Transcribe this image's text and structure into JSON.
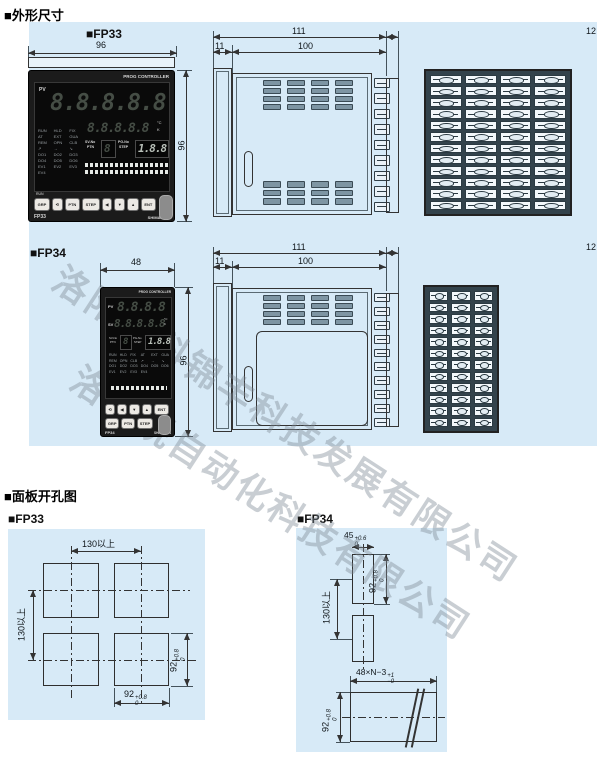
{
  "titles": {
    "outline": "■外形尺寸",
    "cutout": "■面板开孔图"
  },
  "labels": {
    "fp33": "■FP33",
    "fp34": "■FP34",
    "fp33_cut": "■FP33",
    "fp34_cut": "■FP34"
  },
  "watermark": {
    "line1": "洛阳瑞科锦丰科技发展有限公司",
    "line2": "洛阳锐自动化科技有限公司"
  },
  "colors": {
    "panel_bg": "#d7eaf7",
    "line": "#333333",
    "device": "#1b1b1b"
  },
  "fp33": {
    "front": {
      "brand": "PROG CONTROLLER",
      "pv": "PV",
      "pv_digits": "8.8.8.8.8",
      "sv_digits": "8.8.8.8.8",
      "unit_top": "°C",
      "unit_bottom": "K",
      "ptn_label_top": "SV-No",
      "ptn_label_bottom": "PTN",
      "step_label_top": "PG-No",
      "step_label_bottom": "STEP",
      "ptn_value": "8",
      "step_value": "1.8.8",
      "run": "RUN",
      "status": [
        "RUN",
        "HLD",
        "FIX",
        "AT",
        "EXT",
        "GUA",
        "REM",
        "OPN",
        "CLB",
        "↗",
        "→",
        "↘",
        "DO1",
        "DO2",
        "DO3",
        "DO4",
        "DO5",
        "DO6",
        "EV1",
        "EV2",
        "EV3",
        "EV4"
      ],
      "buttons": [
        "GRP",
        "⟲",
        "PTN",
        "STEP",
        "◀",
        "▼",
        "▲",
        "ENT"
      ],
      "model": "FP33",
      "maker": "SHIMADEN"
    },
    "dims": {
      "front_width": "96",
      "front_height": "96",
      "depth_total": "111",
      "depth_body": "100",
      "bezel": "11",
      "terminal": "12"
    }
  },
  "fp34": {
    "front": {
      "brand": "PROG CONTROLLER",
      "pv": "PV",
      "sv": "SV",
      "pv_digits": "8.8.8.8",
      "sv_digits": "8.8.8.8.8",
      "unit_top": "°C",
      "unit_bottom": "K",
      "ptn_label_top": "SV-No",
      "ptn_label_bottom": "PTN",
      "step_label_top": "PG-No",
      "step_label_bottom": "STEP",
      "ptn_value": "8",
      "step_value": "1.8.8",
      "status": [
        "RUN",
        "HLD",
        "FIX",
        "AT",
        "EXT",
        "GUA",
        "REM",
        "OPN",
        "CLB",
        "↗",
        "→",
        "↘",
        "DO1",
        "DO2",
        "DO3",
        "DO4",
        "DO5",
        "DO6",
        "EV1",
        "EV2",
        "EV3",
        "EV4"
      ],
      "buttons_row1": [
        "⟲",
        "◀",
        "▼",
        "▲",
        "ENT"
      ],
      "buttons_row2": [
        "GRP",
        "PTN",
        "STEP"
      ],
      "model": "FP34",
      "maker": "SHIMADEN"
    },
    "dims": {
      "front_width": "48",
      "front_height": "96",
      "depth_total": "111",
      "depth_body": "100",
      "bezel": "11",
      "terminal": "12"
    }
  },
  "fp33_cutout": {
    "h_pitch": "130以上",
    "v_pitch": "130以上",
    "w": "92",
    "w_tol_up": "+0.8",
    "w_tol_dn": "0",
    "h": "92",
    "h_tol_up": "+0.8",
    "h_tol_dn": "0"
  },
  "fp34_cutout": {
    "w": "45",
    "w_tol_up": "+0.6",
    "w_tol_dn": "0",
    "h": "92",
    "h_tol_up": "+0.8",
    "h_tol_dn": "0",
    "v_pitch": "130以上",
    "strip": "48×N−3",
    "strip_tol_up": "+1",
    "strip_tol_dn": "−0",
    "strip_h": "92",
    "strip_h_tol_up": "+0.8",
    "strip_h_tol_dn": "0"
  }
}
